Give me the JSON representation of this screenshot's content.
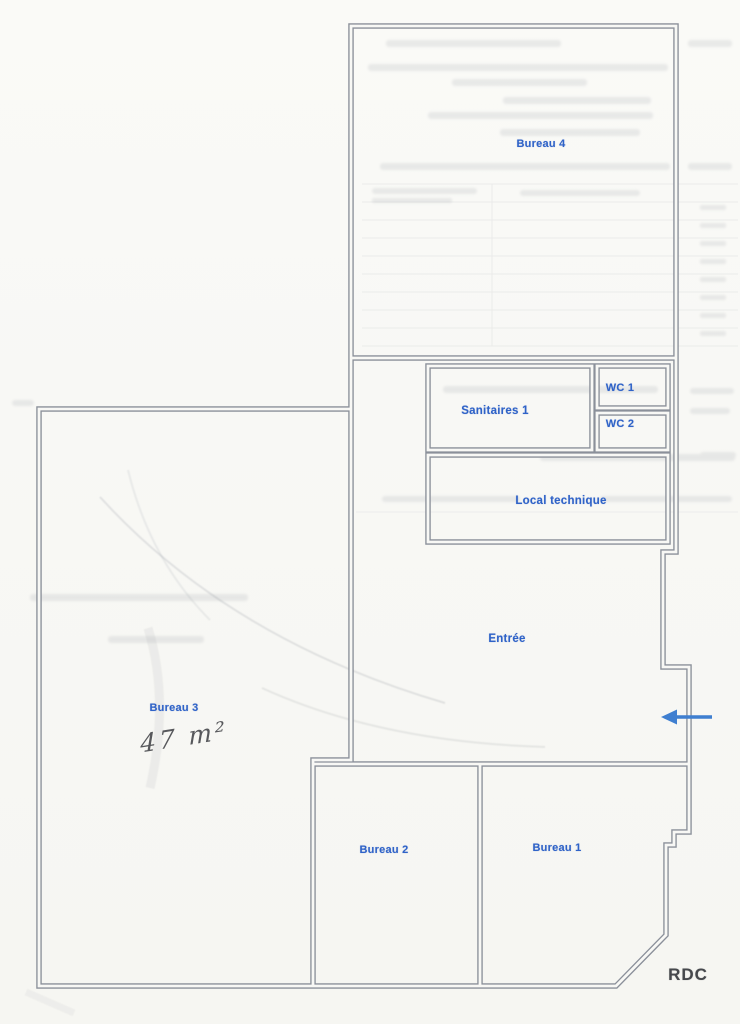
{
  "document": {
    "type_label": "floor-plan",
    "floor_label": "RDC"
  },
  "rooms": [
    {
      "id": "bureau-4",
      "label": "Bureau 4"
    },
    {
      "id": "sanitaires-1",
      "label": "Sanitaires 1"
    },
    {
      "id": "wc-1",
      "label": "WC 1"
    },
    {
      "id": "wc-2",
      "label": "WC 2"
    },
    {
      "id": "local-technique",
      "label": "Local technique"
    },
    {
      "id": "entree",
      "label": "Entrée"
    },
    {
      "id": "bureau-3",
      "label": "Bureau 3",
      "handwritten_area": "47 m²"
    },
    {
      "id": "bureau-2",
      "label": "Bureau 2"
    },
    {
      "id": "bureau-1",
      "label": "Bureau 1"
    }
  ],
  "entrance_arrow": {
    "direction": "left",
    "meaning": "building entrance"
  },
  "colors": {
    "wall": "#8b909a",
    "label_blue": "#2f63c8",
    "arrow_blue": "#3f7fd0",
    "handwriting": "#3b3d41",
    "floor_label": "#46484c",
    "paper": "#f8f8f5",
    "ghost": "#8f949c"
  }
}
